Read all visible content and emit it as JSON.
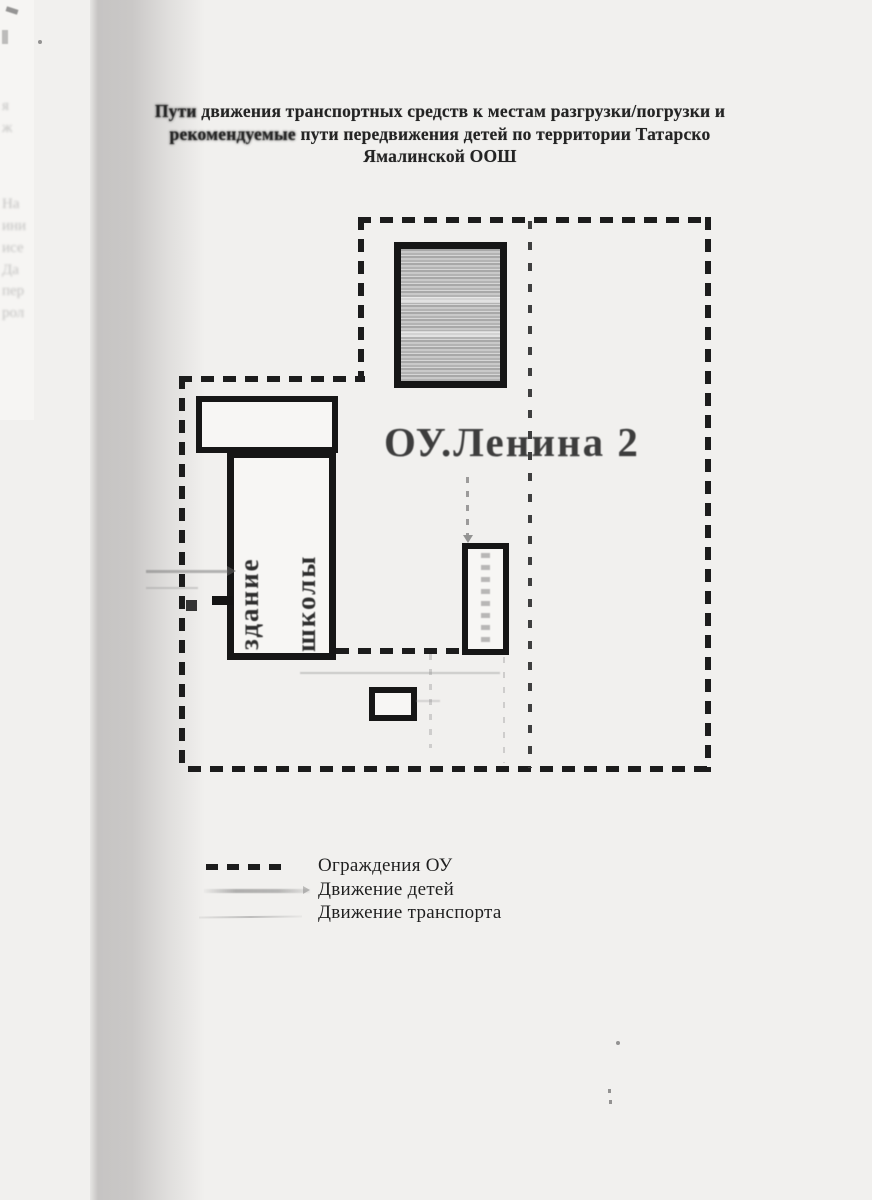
{
  "document": {
    "title_line1_lead": "Пути",
    "title_line1_rest": " движения транспортных средств к местам разгрузки/погрузки и",
    "title_line2_lead": "рекомендуемые",
    "title_line2_rest": " пути передвижения детей по территории Татарско",
    "title_line3": "Ямалинской ООШ"
  },
  "plan": {
    "street_label": "ОУ.Ленина 2",
    "school_building_label_word1": "здание",
    "school_building_label_word2": "школы"
  },
  "legend": {
    "items": [
      {
        "label": "Ограждения ОУ",
        "symbol": "bold-dashed-line"
      },
      {
        "label": "Движение детей",
        "symbol": "gray-gradient-line"
      },
      {
        "label": "Движение транспорта",
        "symbol": "thin-light-line"
      }
    ]
  },
  "colors": {
    "ink": "#1c1c1c",
    "paper": "#f1f0ee",
    "scan_shadow_band": "#c8c6c5",
    "building_fill": "#f7f6f4",
    "hatch_gray": "#b5b5b5",
    "street_text": "#3d3d3d"
  },
  "artifacts": {
    "bleed_fragments": [
      {
        "text": "я",
        "y": 98
      },
      {
        "text": "ж",
        "y": 120
      },
      {
        "text": "На",
        "y": 196
      },
      {
        "text": "ини",
        "y": 218
      },
      {
        "text": "исе",
        "y": 240
      },
      {
        "text": "Да",
        "y": 262
      },
      {
        "text": "пер",
        "y": 283
      },
      {
        "text": "рол",
        "y": 305
      }
    ]
  }
}
